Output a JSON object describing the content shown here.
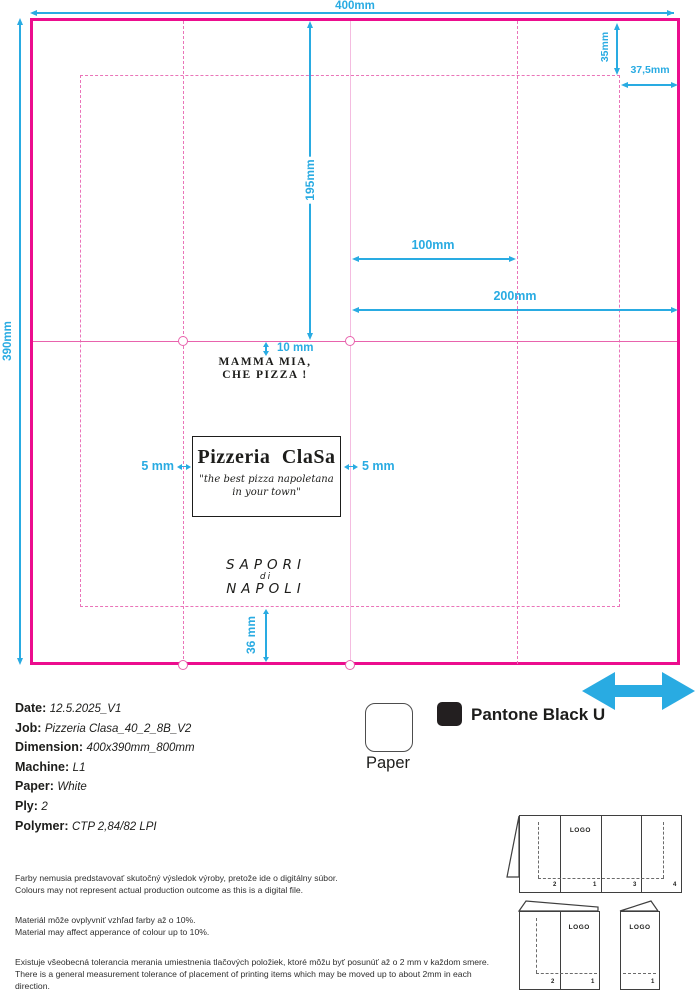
{
  "colors": {
    "magenta": "#EC0D8E",
    "magenta_light": "#F4BCE0",
    "cyan": "#29ABE2",
    "ink": "#1D1D1B",
    "pantone_black": "#231F20"
  },
  "dieline": {
    "width_label": "400mm",
    "height_label": "390mm",
    "center_fold_label": "195mm",
    "flap_height_label": "35mm",
    "flap_width_label": "37,5mm",
    "panel_100_label": "100mm",
    "panel_200_label": "200mm",
    "offset_10_label": "10 mm",
    "margin_left_label": "5 mm",
    "margin_right_label": "5 mm",
    "offset_36_label": "36 mm",
    "slogan_line1": "MAMMA MIA,",
    "slogan_line2": "CHE PIZZA !",
    "logo": {
      "title": "Pizzeria ClaSa",
      "tagline_line1": "\"the best pizza napoletana",
      "tagline_line2": "in your town\""
    },
    "back_text": {
      "line1": "SAPORI",
      "line2": "di",
      "line3": "NAPOLI"
    }
  },
  "specs": [
    {
      "label": "Date:",
      "value": "12.5.2025_V1"
    },
    {
      "label": "Job:",
      "value": "Pizzeria Clasa_40_2_8B_V2"
    },
    {
      "label": "Dimension:",
      "value": "400x390mm_800mm"
    },
    {
      "label": "Machine:",
      "value": "L1"
    },
    {
      "label": "Paper:",
      "value": "White"
    },
    {
      "label": "Ply:",
      "value": "2"
    },
    {
      "label": "Polymer:",
      "value": "CTP 2,84/82 LPI"
    }
  ],
  "legend": {
    "paper_label": "Paper",
    "pantone_label": "Pantone Black U"
  },
  "disclaimers": [
    {
      "sk": "Farby nemusia predstavovať skutočný výsledok výroby, pretože ide o digitálny súbor.",
      "en": "Colours may not represent actual production outcome as this is a digital file."
    },
    {
      "sk": "Materiál môže ovplyvniť vzhľad farby až o 10%.",
      "en": "Material may affect apperance of colour up to 10%."
    },
    {
      "sk": "Existuje všeobecná tolerancia merania umiestnenia tlačových položiek, ktoré môžu byť posunúť až o 2 mm v každom smere.",
      "en": "There is a general measurement tolerance of placement of printing items which may be moved up to about 2mm in each direction."
    }
  ],
  "fold_diagrams": {
    "logo_label": "LOGO",
    "quad_panels": [
      "2",
      "1",
      "3",
      "4"
    ],
    "bi_panels": [
      "2",
      "1"
    ],
    "single_panels": [
      "1"
    ]
  }
}
